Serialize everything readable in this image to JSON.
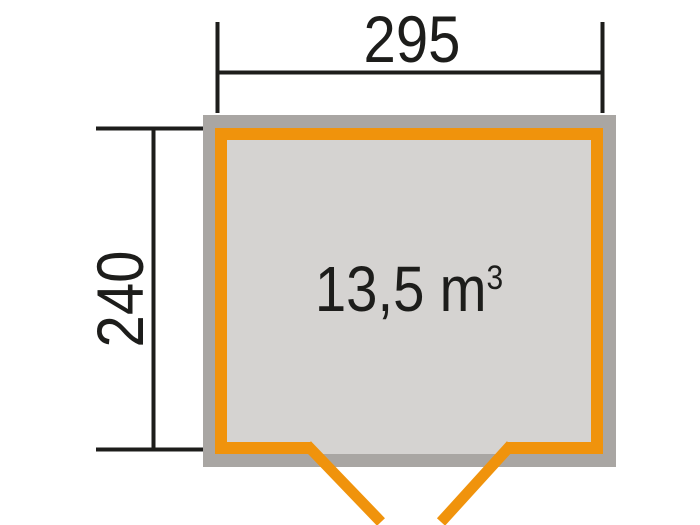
{
  "colors": {
    "wall_outline_gray": "#a9a6a3",
    "wall_orange": "#f0930c",
    "floor_gray": "#d5d3d1",
    "dimension_line": "#1d1d1b"
  },
  "plan": {
    "width_dimension": "295",
    "depth_dimension": "240",
    "volume": {
      "value": "13,5",
      "unit": "m",
      "exponent": "3"
    }
  }
}
